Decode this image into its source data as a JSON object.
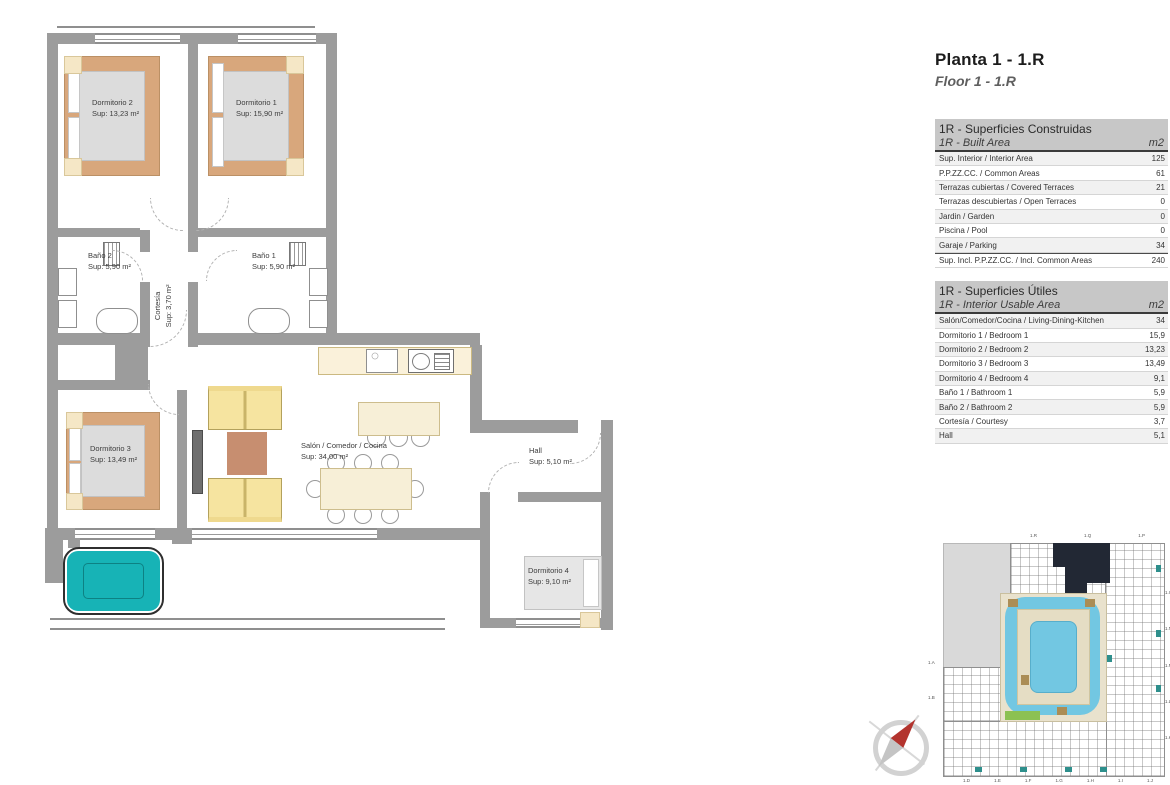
{
  "page": {
    "title": "Planta 1 - 1.R",
    "subtitle": "Floor 1 - 1.R"
  },
  "floorplan": {
    "rooms": {
      "dormitorio2": {
        "name": "Dormitorio 2",
        "sup": "Sup: 13,23 m²"
      },
      "dormitorio1": {
        "name": "Dormitorio 1",
        "sup": "Sup: 15,90 m²"
      },
      "bano2": {
        "name": "Baño 2",
        "sup": "Sup: 5,90 m²"
      },
      "bano1": {
        "name": "Baño 1",
        "sup": "Sup: 5,90 m²"
      },
      "cortesia": {
        "name": "Cortesía",
        "sup": "Sup: 3,70 m²"
      },
      "dormitorio3": {
        "name": "Dormitorio 3",
        "sup": "Sup: 13,49 m²"
      },
      "salon": {
        "name": "Salón / Comedor / Cocina",
        "sup": "Sup: 34,00 m²"
      },
      "hall": {
        "name": "Hall",
        "sup": "Sup: 5,10 m²"
      },
      "dormitorio4": {
        "name": "Dormitorio 4",
        "sup": "Sup: 9,10 m²"
      }
    }
  },
  "tables": {
    "built": {
      "title_es": "1R - Superficies Construidas",
      "title_en": "1R - Built Area",
      "unit": "m2",
      "rows": [
        {
          "label": "Sup. Interior / Interior Area",
          "value": "125"
        },
        {
          "label": "P.P.ZZ.CC. / Common Areas",
          "value": "61"
        },
        {
          "label": "Terrazas cubiertas / Covered Terraces",
          "value": "21"
        },
        {
          "label": "Terrazas descubiertas / Open Terraces",
          "value": "0"
        },
        {
          "label": "Jardin / Garden",
          "value": "0"
        },
        {
          "label": "Piscina / Pool",
          "value": "0"
        },
        {
          "label": "Garaje / Parking",
          "value": "34"
        },
        {
          "label": "Sup. Incl. P.P.ZZ.CC. / Incl. Common Areas",
          "value": "240"
        }
      ]
    },
    "usable": {
      "title_es": "1R - Superficies Útiles",
      "title_en": "1R - Interior Usable Area",
      "unit": "m2",
      "rows": [
        {
          "label": "Salón/Comedor/Cocina / Living-Dining-Kitchen",
          "value": "34"
        },
        {
          "label": "Dormitorio 1 / Bedroom 1",
          "value": "15,9"
        },
        {
          "label": "Dormitorio 2 / Bedroom 2",
          "value": "13,23"
        },
        {
          "label": "Dormitorio 3 / Bedroom 3",
          "value": "13,49"
        },
        {
          "label": "Dormitorio 4 / Bedroom 4",
          "value": "9,1"
        },
        {
          "label": "Baño 1 / Bathroom 1",
          "value": "5,9"
        },
        {
          "label": "Baño 2 / Bathroom 2",
          "value": "5,9"
        },
        {
          "label": "Cortesía / Courtesy",
          "value": "3,7"
        },
        {
          "label": "Hall",
          "value": "5,1"
        }
      ]
    }
  },
  "siteplan": {
    "top_labels": [
      {
        "label": "1.R"
      },
      {
        "label": "1.Q"
      },
      {
        "label": "1.P"
      }
    ],
    "right_labels": [
      {
        "label": "1.O"
      },
      {
        "label": "1.N"
      },
      {
        "label": "1.M"
      },
      {
        "label": "1.L"
      },
      {
        "label": "1.K"
      }
    ],
    "bottom_labels": [
      {
        "label": "1.D"
      },
      {
        "label": "1.E"
      },
      {
        "label": "1.F"
      },
      {
        "label": "1.G"
      },
      {
        "label": "1.H"
      },
      {
        "label": "1.I"
      },
      {
        "label": "1.J"
      }
    ],
    "left_labels": [
      {
        "label": "1.A"
      },
      {
        "label": "1.B"
      }
    ]
  },
  "colors": {
    "wall_gray": "#9c9c9c",
    "table_header_gray": "#c7c7c7",
    "jacuzzi_teal": "#17b3b6",
    "bed_tan": "#d8a77c",
    "sofa_yellow": "#f6e4a0",
    "rug_terracotta": "#c78e70",
    "furniture_cream": "#f7efd7",
    "pool_blue": "#72c7e2",
    "highlighted_unit_navy": "#222834",
    "compass_red": "#b3342e"
  }
}
